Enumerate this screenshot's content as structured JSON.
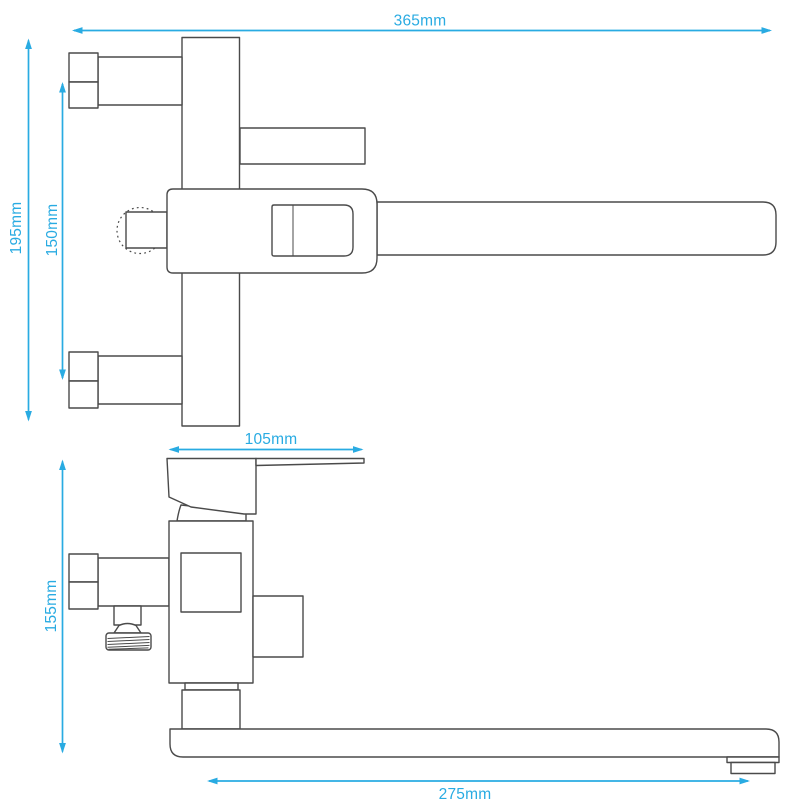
{
  "colors": {
    "outline": "#4a4a4a",
    "dimension": "#29abe2",
    "background": "#ffffff"
  },
  "dimensions": [
    {
      "label": "365mm"
    },
    {
      "label": "195mm"
    },
    {
      "label": "150mm"
    },
    {
      "label": "105mm"
    },
    {
      "label": "155mm"
    },
    {
      "label": "275mm"
    }
  ]
}
